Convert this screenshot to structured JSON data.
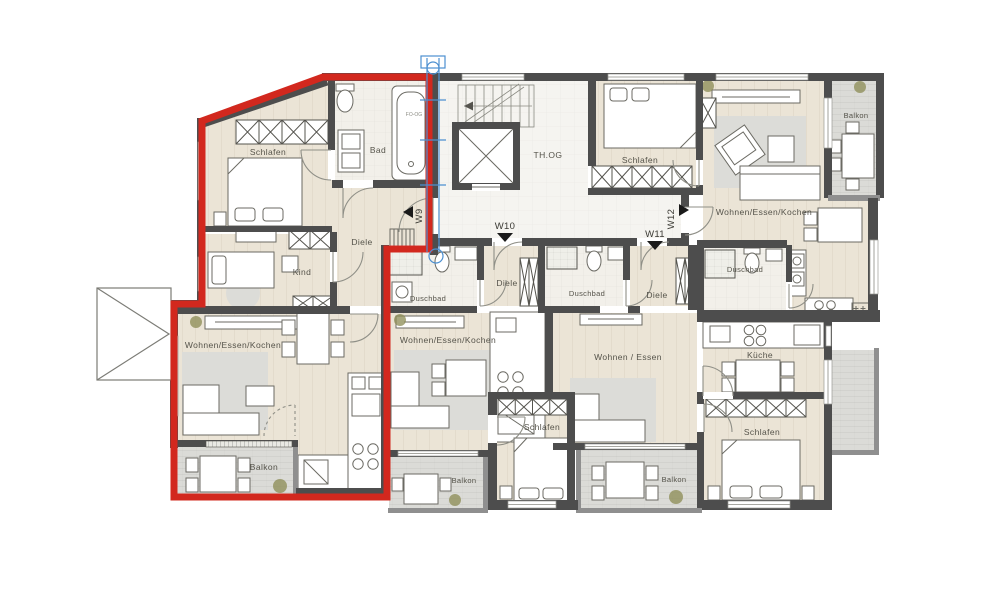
{
  "rooms": {
    "w9": {
      "schlafen": "Schlafen",
      "bad": "Bad",
      "diele": "Diele",
      "kind": "Kind",
      "wohnen": "Wohnen/Essen/Kochen",
      "balkon": "Balkon"
    },
    "w10": {
      "duschbad": "Duschbad",
      "diele": "Diele",
      "wohnen": "Wohnen/Essen/Kochen",
      "schlafen": "Schlafen",
      "balkon": "Balkon"
    },
    "w11": {
      "duschbad": "Duschbad",
      "diele": "Diele",
      "wohnen": "Wohnen / Essen",
      "kueche": "Küche",
      "schlafen": "Schlafen",
      "balkon": "Balkon"
    },
    "w12": {
      "schlafen": "Schlafen",
      "wohnen": "Wohnen/Essen/Kochen",
      "duschbad": "Duschbad",
      "balkon": "Balkon"
    }
  },
  "units": {
    "w9": "W9",
    "w10": "W10",
    "w11": "W11",
    "w12": "W12"
  },
  "stairwell": {
    "label": "TH.OG",
    "note": "FO-OG"
  },
  "colors": {
    "highlight_red": "#d2281e",
    "section_blue": "#4c8fd0",
    "wall_dark": "#4d4d4d",
    "floor_beige": "#ebe4d6",
    "balcony_gray": "#dbdbd7"
  }
}
